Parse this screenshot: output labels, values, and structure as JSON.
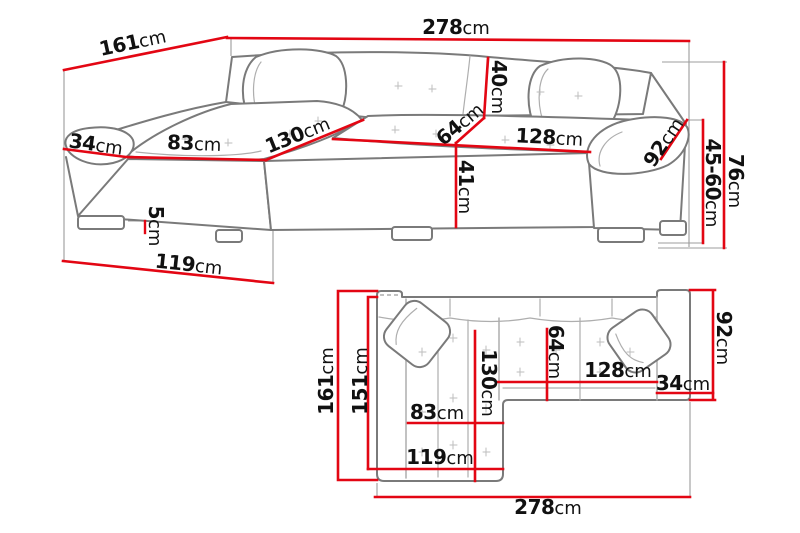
{
  "title": "Corner sofa dimensions diagram",
  "unit": "cm",
  "colors": {
    "dimension_red": "#e30613",
    "sketch_gray": "#7a7a7a",
    "inner_gray": "#aeaeae",
    "extension_gray": "#9c9c9c",
    "tuft_gray": "#bdbdbd",
    "text_black": "#111111",
    "background": "#ffffff"
  },
  "views": {
    "perspective": {
      "dims": {
        "side_depth": {
          "value": "161",
          "unit": "cm"
        },
        "total_width": {
          "value": "278",
          "unit": "cm"
        },
        "left_arm_width": {
          "value": "34",
          "unit": "cm"
        },
        "chaise_seat_width": {
          "value": "83",
          "unit": "cm"
        },
        "chaise_length": {
          "value": "130",
          "unit": "cm"
        },
        "backrest_height": {
          "value": "40",
          "unit": "cm"
        },
        "seat_depth": {
          "value": "64",
          "unit": "cm"
        },
        "seat_width": {
          "value": "128",
          "unit": "cm"
        },
        "right_arm_length": {
          "value": "92",
          "unit": "cm"
        },
        "front_height": {
          "value": "41",
          "unit": "cm"
        },
        "total_height": {
          "value": "76",
          "unit": "cm"
        },
        "seat_height_range": {
          "value": "45-60",
          "unit": "cm"
        },
        "leg_height": {
          "value": "5",
          "unit": "cm"
        },
        "chaise_front_width": {
          "value": "119",
          "unit": "cm"
        }
      }
    },
    "plan": {
      "dims": {
        "total_depth": {
          "value": "161",
          "unit": "cm"
        },
        "inner_depth": {
          "value": "151",
          "unit": "cm"
        },
        "chaise_seat_width": {
          "value": "83",
          "unit": "cm"
        },
        "chaise_width": {
          "value": "119",
          "unit": "cm"
        },
        "chaise_length": {
          "value": "130",
          "unit": "cm"
        },
        "seat_depth": {
          "value": "64",
          "unit": "cm"
        },
        "seat_width": {
          "value": "128",
          "unit": "cm"
        },
        "arm_width": {
          "value": "34",
          "unit": "cm"
        },
        "body_depth": {
          "value": "92",
          "unit": "cm"
        },
        "total_width": {
          "value": "278",
          "unit": "cm"
        }
      }
    }
  }
}
